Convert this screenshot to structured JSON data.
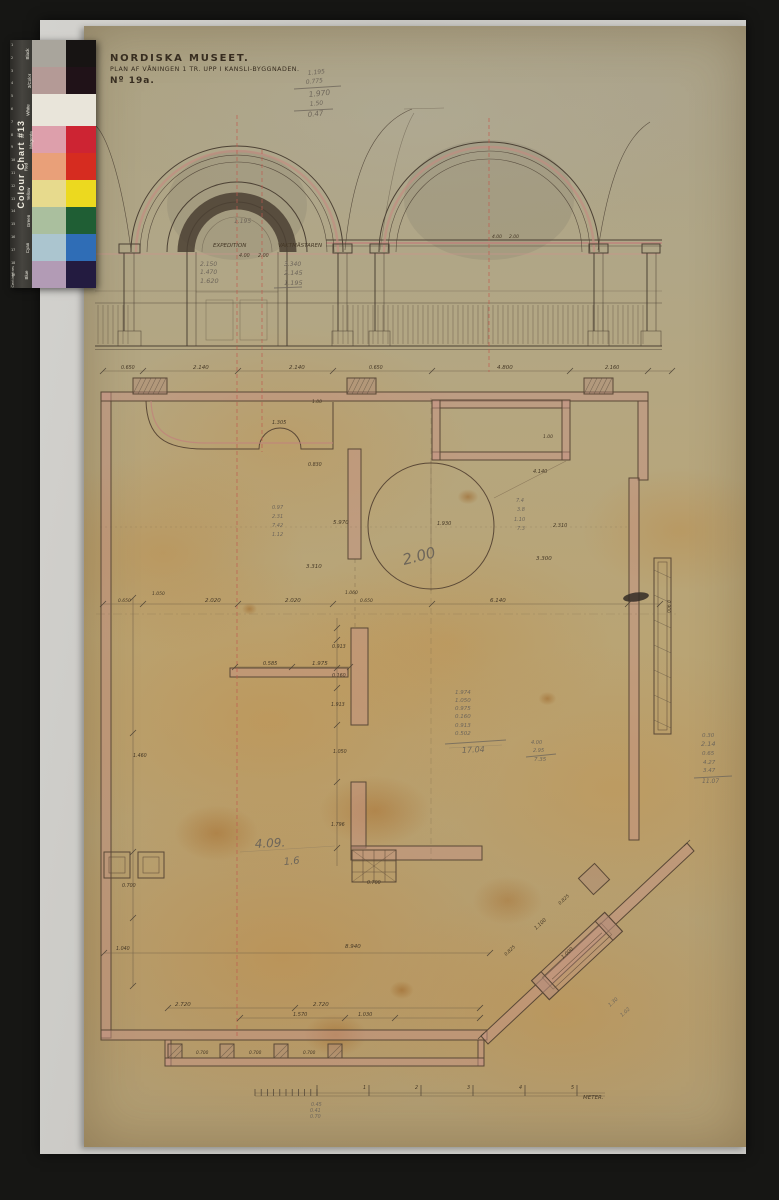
{
  "title_block": {
    "line1": "NORDISKA MUSEET.",
    "line2": "PLAN AF VÅNINGEN 1 TR. UPP I KANSLI-BYGGNADEN.",
    "line3": "Nº 19a."
  },
  "color_chart": {
    "title": "Colour Chart #13",
    "side_label": "Centimetres",
    "ruler_numbers": [
      "1",
      "2",
      "3",
      "4",
      "5",
      "6",
      "7",
      "8",
      "9",
      "10",
      "11",
      "12",
      "13",
      "14",
      "15",
      "16",
      "17",
      "18",
      "19"
    ],
    "rows": [
      {
        "label": "Black",
        "light": "#a9a59c",
        "full": "#171413"
      },
      {
        "label": "3/Color",
        "light": "#b49a96",
        "full": "#201218"
      },
      {
        "label": "White",
        "light": "#e9e5da",
        "wide": true,
        "h": 32
      },
      {
        "label": "Magenta",
        "light": "#dd9fab",
        "full": "#cd2433"
      },
      {
        "label": "Red",
        "light": "#e9a079",
        "full": "#d62c20"
      },
      {
        "label": "Yellow",
        "light": "#e7da8d",
        "full": "#ecd91f"
      },
      {
        "label": "Green",
        "light": "#aabf9e",
        "full": "#1f5e34"
      },
      {
        "label": "Cyan",
        "light": "#abc5cf",
        "full": "#2f6db6"
      },
      {
        "label": "Blue",
        "light": "#b29bb5",
        "full": "#231b40"
      }
    ]
  },
  "drawing": {
    "annotations": [
      {
        "x": 213,
        "y": 247,
        "t": "EXPEDITION",
        "s": 5.5
      },
      {
        "x": 278,
        "y": 247,
        "t": "VAKTMÄSTAREN",
        "s": 5.5
      },
      {
        "x": 239,
        "y": 257,
        "t": "4.00",
        "s": 4.8
      },
      {
        "x": 258,
        "y": 257,
        "t": "2.00",
        "s": 4.8
      },
      {
        "x": 200,
        "y": 266,
        "t": "2.150",
        "c": "p",
        "s": 6
      },
      {
        "x": 200,
        "y": 274,
        "t": "1.470",
        "c": "p",
        "s": 6
      },
      {
        "x": 200,
        "y": 283,
        "t": "1.620",
        "c": "p",
        "s": 6.5
      },
      {
        "x": 284,
        "y": 266,
        "t": "3.340",
        "c": "p",
        "s": 6
      },
      {
        "x": 284,
        "y": 275,
        "t": "2.145",
        "c": "p",
        "s": 6.5
      },
      {
        "x": 284,
        "y": 285,
        "t": "1.195",
        "c": "p",
        "s": 6.5
      },
      {
        "x": 234,
        "y": 223,
        "t": "1.195",
        "c": "p",
        "s": 6
      },
      {
        "x": 492,
        "y": 238,
        "t": "4.00",
        "s": 4.5
      },
      {
        "x": 509,
        "y": 238,
        "t": "2.00",
        "s": 4.5
      },
      {
        "x": 308,
        "y": 75,
        "t": "1.195",
        "c": "p",
        "s": 6,
        "r": -6
      },
      {
        "x": 306,
        "y": 84,
        "t": "0.775",
        "c": "p",
        "s": 6,
        "r": -6
      },
      {
        "x": 309,
        "y": 97,
        "t": "1.970",
        "c": "p",
        "s": 7.5,
        "r": -6
      },
      {
        "x": 310,
        "y": 106,
        "t": "1.50",
        "c": "p",
        "s": 6,
        "r": -6
      },
      {
        "x": 308,
        "y": 117,
        "t": "0.47",
        "c": "p",
        "s": 7,
        "r": -6
      },
      {
        "x": 121,
        "y": 369,
        "t": "0.650",
        "s": 4.8
      },
      {
        "x": 193,
        "y": 369,
        "t": "2.140",
        "s": 5.5
      },
      {
        "x": 289,
        "y": 369,
        "t": "2.140",
        "s": 5.5
      },
      {
        "x": 369,
        "y": 369,
        "t": "0.650",
        "s": 4.8
      },
      {
        "x": 497,
        "y": 369,
        "t": "4.800",
        "s": 5.5
      },
      {
        "x": 605,
        "y": 369,
        "t": "2.160",
        "s": 5
      },
      {
        "x": 312,
        "y": 403,
        "t": "1.00",
        "s": 4.5
      },
      {
        "x": 272,
        "y": 424,
        "t": "1.305",
        "s": 5
      },
      {
        "x": 308,
        "y": 466,
        "t": "0.830",
        "s": 4.8
      },
      {
        "x": 543,
        "y": 438,
        "t": "1.00",
        "s": 4.5
      },
      {
        "x": 533,
        "y": 473,
        "t": "4.140",
        "s": 5
      },
      {
        "x": 333,
        "y": 524,
        "t": "5.970",
        "s": 5.5
      },
      {
        "x": 553,
        "y": 527,
        "t": "2.310",
        "s": 5
      },
      {
        "x": 437,
        "y": 525,
        "t": "1.930",
        "s": 5
      },
      {
        "x": 536,
        "y": 560,
        "t": "3.300",
        "s": 5.5
      },
      {
        "x": 306,
        "y": 568,
        "t": "3.310",
        "s": 5.5
      },
      {
        "x": 516,
        "y": 502,
        "t": "7.4",
        "c": "p",
        "s": 5
      },
      {
        "x": 517,
        "y": 511,
        "t": "3.8",
        "c": "p",
        "s": 5
      },
      {
        "x": 514,
        "y": 521,
        "t": "1.10",
        "c": "p",
        "s": 5
      },
      {
        "x": 517,
        "y": 530,
        "t": "7.3",
        "c": "p",
        "s": 5
      },
      {
        "x": 272,
        "y": 509,
        "t": "0.97",
        "c": "p",
        "s": 5
      },
      {
        "x": 272,
        "y": 518,
        "t": "2.31",
        "c": "p",
        "s": 5
      },
      {
        "x": 272,
        "y": 527,
        "t": "7.42",
        "c": "p",
        "s": 5
      },
      {
        "x": 272,
        "y": 536,
        "t": "1.12",
        "c": "p",
        "s": 5
      },
      {
        "x": 404,
        "y": 565,
        "t": "2.00",
        "c": "p",
        "s": 15,
        "r": -14
      },
      {
        "x": 118,
        "y": 602,
        "t": "0.650",
        "s": 4.5
      },
      {
        "x": 152,
        "y": 595,
        "t": "1.050",
        "s": 4.5
      },
      {
        "x": 205,
        "y": 602,
        "t": "2.020",
        "s": 5.5
      },
      {
        "x": 285,
        "y": 602,
        "t": "2.020",
        "s": 5.5
      },
      {
        "x": 490,
        "y": 602,
        "t": "6.140",
        "s": 5.5
      },
      {
        "x": 345,
        "y": 594,
        "t": "1.060",
        "s": 4.5
      },
      {
        "x": 360,
        "y": 602,
        "t": "0.650",
        "s": 4.5
      },
      {
        "x": 263,
        "y": 665,
        "t": "0.585",
        "s": 5
      },
      {
        "x": 312,
        "y": 665,
        "t": "1.975",
        "s": 5.5
      },
      {
        "x": 332,
        "y": 648,
        "t": "0.913",
        "s": 4.8
      },
      {
        "x": 332,
        "y": 677,
        "t": "0.160",
        "s": 4.8
      },
      {
        "x": 331,
        "y": 706,
        "t": "1.913",
        "s": 4.8
      },
      {
        "x": 333,
        "y": 753,
        "t": "1.050",
        "s": 4.8
      },
      {
        "x": 331,
        "y": 826,
        "t": "1.796",
        "s": 4.8
      },
      {
        "x": 455,
        "y": 694,
        "t": "1.974",
        "c": "p",
        "s": 5.5
      },
      {
        "x": 455,
        "y": 702,
        "t": "1.050",
        "c": "p",
        "s": 5.5
      },
      {
        "x": 455,
        "y": 710,
        "t": "0.975",
        "c": "p",
        "s": 5.5
      },
      {
        "x": 455,
        "y": 718,
        "t": "0.160",
        "c": "p",
        "s": 5.5
      },
      {
        "x": 455,
        "y": 727,
        "t": "0.913",
        "c": "p",
        "s": 5.5
      },
      {
        "x": 455,
        "y": 735,
        "t": "0.502",
        "c": "p",
        "s": 5.5
      },
      {
        "x": 462,
        "y": 753,
        "t": "17.04",
        "c": "p",
        "s": 8,
        "r": -3
      },
      {
        "x": 531,
        "y": 744,
        "t": "4.00",
        "c": "p",
        "s": 5
      },
      {
        "x": 533,
        "y": 752,
        "t": "2.95",
        "c": "p",
        "s": 5
      },
      {
        "x": 534,
        "y": 761,
        "t": "7.35",
        "c": "p",
        "s": 5.5
      },
      {
        "x": 702,
        "y": 737,
        "t": "0.30",
        "c": "p",
        "s": 5.5
      },
      {
        "x": 701,
        "y": 746,
        "t": "2.14",
        "c": "p",
        "s": 6.5
      },
      {
        "x": 702,
        "y": 755,
        "t": "0.65",
        "c": "p",
        "s": 5.5
      },
      {
        "x": 703,
        "y": 764,
        "t": "4.27",
        "c": "p",
        "s": 5.5
      },
      {
        "x": 703,
        "y": 772,
        "t": "3.47",
        "c": "p",
        "s": 5.5
      },
      {
        "x": 702,
        "y": 783,
        "t": "11.07",
        "c": "p",
        "s": 6
      },
      {
        "x": 133,
        "y": 757,
        "t": "1.460",
        "s": 4.8
      },
      {
        "x": 122,
        "y": 887,
        "t": "0.700",
        "s": 4.8
      },
      {
        "x": 116,
        "y": 950,
        "t": "1.040",
        "s": 4.8
      },
      {
        "x": 367,
        "y": 884,
        "t": "0.700",
        "s": 4.8
      },
      {
        "x": 345,
        "y": 948,
        "t": "8.940",
        "s": 5.5
      },
      {
        "x": 255,
        "y": 848,
        "t": "4.09.",
        "c": "p",
        "s": 12,
        "r": -3
      },
      {
        "x": 284,
        "y": 865,
        "t": "1.6",
        "c": "p",
        "s": 10,
        "r": -5
      },
      {
        "x": 536,
        "y": 930,
        "t": "1.100",
        "s": 5,
        "r": -43
      },
      {
        "x": 563,
        "y": 959,
        "t": "1.000",
        "s": 5,
        "r": -43
      },
      {
        "x": 560,
        "y": 905,
        "t": "0.825",
        "s": 4.5,
        "r": -43
      },
      {
        "x": 506,
        "y": 956,
        "t": "0.825",
        "s": 4.5,
        "r": -43
      },
      {
        "x": 610,
        "y": 1007,
        "t": "1.30",
        "c": "p",
        "s": 5,
        "r": -43
      },
      {
        "x": 622,
        "y": 1017,
        "t": "1.02",
        "c": "p",
        "s": 5,
        "r": -43
      },
      {
        "x": 667,
        "y": 600,
        "t": "0.900",
        "s": 4.5,
        "r": 90
      },
      {
        "x": 175,
        "y": 1006,
        "t": "2.720",
        "s": 5.5
      },
      {
        "x": 313,
        "y": 1006,
        "t": "2.720",
        "s": 5.5
      },
      {
        "x": 293,
        "y": 1016,
        "t": "1.570",
        "s": 5
      },
      {
        "x": 358,
        "y": 1016,
        "t": "1.030",
        "s": 5
      },
      {
        "x": 196,
        "y": 1054,
        "t": "0.700",
        "s": 4.3
      },
      {
        "x": 249,
        "y": 1054,
        "t": "0.700",
        "s": 4.3
      },
      {
        "x": 303,
        "y": 1054,
        "t": "0.700",
        "s": 4.3
      },
      {
        "x": 363,
        "y": 1089,
        "t": "1",
        "s": 4.8
      },
      {
        "x": 415,
        "y": 1089,
        "t": "2",
        "s": 4.8
      },
      {
        "x": 467,
        "y": 1089,
        "t": "3",
        "s": 4.8
      },
      {
        "x": 519,
        "y": 1089,
        "t": "4",
        "s": 4.8
      },
      {
        "x": 571,
        "y": 1089,
        "t": "5",
        "s": 4.8
      },
      {
        "x": 583,
        "y": 1099,
        "t": "METER.",
        "s": 5.5
      },
      {
        "x": 311,
        "y": 1106,
        "t": "0.45",
        "c": "p",
        "s": 4.8
      },
      {
        "x": 310,
        "y": 1112,
        "t": "0.41",
        "c": "p",
        "s": 4.8
      },
      {
        "x": 310,
        "y": 1118,
        "t": "0.70",
        "c": "p",
        "s": 4.8
      }
    ]
  }
}
